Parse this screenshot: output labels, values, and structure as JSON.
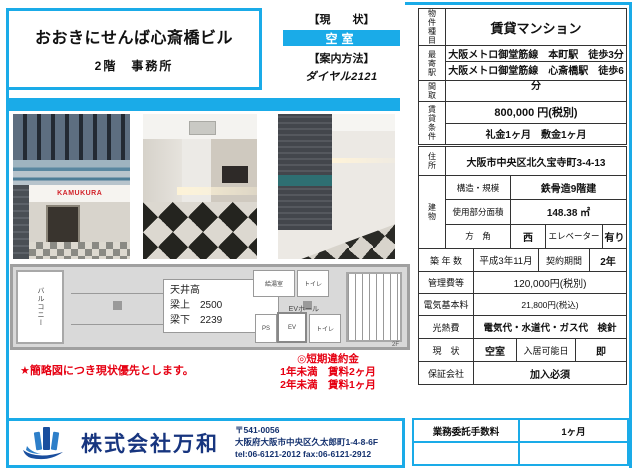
{
  "colors": {
    "accent": "#1aabe8",
    "red": "#e60012",
    "navy": "#17357f"
  },
  "header": {
    "building_name": "おおきにせんば心斎橋ビル",
    "floor_use": "2階　事務所",
    "status_label": "【現　　状】",
    "status_value": "空室",
    "guide_label": "【案内方法】",
    "guide_value": "ダイヤル2121"
  },
  "photos": {
    "storefront_sign": "KAMUKURA"
  },
  "property": {
    "type_label": "物件種目",
    "type_value": "賃貸マンション",
    "station_label": "最寄駅",
    "station_lines": [
      "大阪メトロ御堂筋線　本町駅　徒歩3分",
      "大阪メトロ御堂筋線　心斎橋駅　徒歩6分"
    ],
    "layout_label": "間取",
    "layout_value": "",
    "rent_label": "賃貸条件",
    "rent_value": "800,000 円(税別)",
    "rent_deposit": "礼金1ヶ月　敷金1ヶ月",
    "address_label": "住所",
    "address_value": "大阪市中央区北久宝寺町3-4-13",
    "building_label": "建物",
    "structure_label": "構造・規模",
    "structure_value": "鉄骨造9階建",
    "area_label": "使用部分面積",
    "area_value": "148.38 ㎡",
    "direction_label": "方　角",
    "direction_value": "西",
    "elevator_label": "エレベーター",
    "elevator_value": "有り",
    "age_label": "築 年 数",
    "age_value": "平成3年11月",
    "contract_label": "契約期間",
    "contract_value": "2年",
    "mgmt_label": "管理費等",
    "mgmt_value": "120,000円(税別)",
    "elec_label": "電気基本料",
    "elec_value": "21,800円(税込)",
    "utility_label": "光熱費",
    "utility_value": "電気代・水道代・ガス代　検針",
    "status_label": "現　状",
    "status_value": "空室",
    "movein_label": "入居可能日",
    "movein_value": "即",
    "guarantor_label": "保証会社",
    "guarantor_value": "加入必須"
  },
  "floorplan": {
    "balcony": "バルコニー",
    "note_line1": "天井高",
    "note_line2": "梁上　2500",
    "note_line3": "梁下　2239",
    "kitchen": "給湯室",
    "toilet_top": "トイレ",
    "ev_hall": "EVホール",
    "ps": "PS",
    "ev": "EV",
    "toilet_bottom": "トイレ",
    "floor_label": "2F"
  },
  "notes": {
    "left": "★簡略図につき現状優先とします。",
    "right_title": "◎短期違約金",
    "right_line1": "1年未満　賃料2ヶ月",
    "right_line2": "2年未満　賃料1ヶ月"
  },
  "fee": {
    "label": "業務委託手数料",
    "value": "1ヶ月"
  },
  "footer": {
    "company": "株式会社万和",
    "postal": "〒541-0056",
    "address": "大阪府大阪市中央区久太郎町1-4-8-6F",
    "tel_fax": "tel:06-6121-2012 fax:06-6121-2912"
  }
}
